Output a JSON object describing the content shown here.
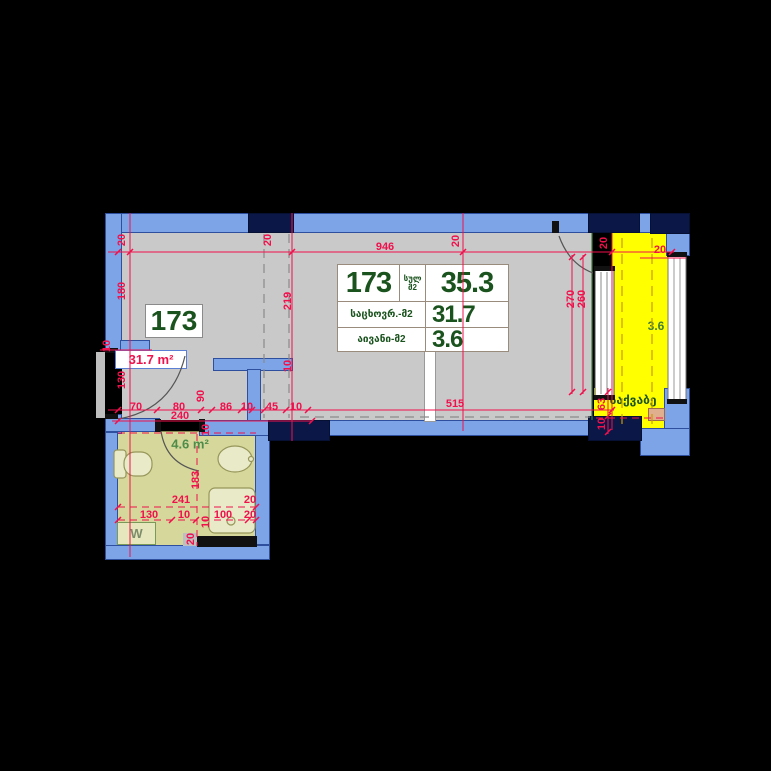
{
  "plan_title": "Apartment floor plan 173",
  "labels": {
    "unit_box": "173",
    "living_area_box": "31.7 m²",
    "bathroom_area": "4.6 m²",
    "balcony_area": "3.6",
    "boiler_room": "საქვაბე",
    "washing_machine": "W"
  },
  "area_table": {
    "unit": "173",
    "total_label_line1": "სულ",
    "total_label_line2": "მ2",
    "total_value": "35.3",
    "living_label": "საცხოვრ.-მ2",
    "living_value": "31.7",
    "balcony_label": "აივანი-მ2",
    "balcony_value": "3.6"
  },
  "dimensions": [
    {
      "t": "20",
      "cx": 122,
      "cy": 240,
      "r": 90
    },
    {
      "t": "180",
      "cx": 122,
      "cy": 291,
      "r": 90
    },
    {
      "t": "10",
      "cx": 107,
      "cy": 346,
      "r": 90
    },
    {
      "t": "130",
      "cx": 122,
      "cy": 380,
      "r": 90
    },
    {
      "t": "70",
      "cx": 136,
      "cy": 407,
      "r": 0
    },
    {
      "t": "80",
      "cx": 179,
      "cy": 407,
      "r": 0
    },
    {
      "t": "240",
      "cx": 180,
      "cy": 416,
      "r": 0
    },
    {
      "t": "90",
      "cx": 201,
      "cy": 396,
      "r": 90
    },
    {
      "t": "10",
      "cx": 206,
      "cy": 430,
      "r": 90
    },
    {
      "t": "86",
      "cx": 226,
      "cy": 407,
      "r": 0
    },
    {
      "t": "10",
      "cx": 247,
      "cy": 407,
      "r": 0
    },
    {
      "t": "45",
      "cx": 272,
      "cy": 407,
      "r": 0
    },
    {
      "t": "10",
      "cx": 296,
      "cy": 407,
      "r": 0
    },
    {
      "t": "20",
      "cx": 268,
      "cy": 240,
      "r": 90
    },
    {
      "t": "219",
      "cx": 288,
      "cy": 301,
      "r": 90
    },
    {
      "t": "10",
      "cx": 288,
      "cy": 366,
      "r": 90
    },
    {
      "t": "946",
      "cx": 385,
      "cy": 247,
      "r": 0
    },
    {
      "t": "20",
      "cx": 456,
      "cy": 241,
      "r": 90
    },
    {
      "t": "515",
      "cx": 455,
      "cy": 404,
      "r": 0
    },
    {
      "t": "270",
      "cx": 571,
      "cy": 299,
      "r": 90
    },
    {
      "t": "260",
      "cx": 582,
      "cy": 299,
      "r": 90
    },
    {
      "t": "20",
      "cx": 604,
      "cy": 243,
      "r": 90
    },
    {
      "t": "20",
      "cx": 660,
      "cy": 250,
      "r": 0
    },
    {
      "t": "63",
      "cx": 602,
      "cy": 404,
      "r": 90
    },
    {
      "t": "10",
      "cx": 602,
      "cy": 424,
      "r": 90
    },
    {
      "t": "183",
      "cx": 196,
      "cy": 480,
      "r": 90
    },
    {
      "t": "241",
      "cx": 181,
      "cy": 500,
      "r": 0
    },
    {
      "t": "130",
      "cx": 149,
      "cy": 515,
      "r": 0
    },
    {
      "t": "10",
      "cx": 184,
      "cy": 515,
      "r": 0
    },
    {
      "t": "100",
      "cx": 223,
      "cy": 515,
      "r": 0
    },
    {
      "t": "20",
      "cx": 250,
      "cy": 500,
      "r": 0
    },
    {
      "t": "20",
      "cx": 250,
      "cy": 515,
      "r": 0
    },
    {
      "t": "10",
      "cx": 206,
      "cy": 522,
      "r": 90
    },
    {
      "t": "20",
      "cx": 191,
      "cy": 539,
      "r": 90
    }
  ],
  "colors": {
    "wall_fill": "#7da4e6",
    "wall_stroke": "#2e4f9e",
    "column": "#0a1747",
    "room_floor": "#c9c9c9",
    "bathroom_floor": "#d6d79b",
    "balcony_floor": "#ffff00",
    "dimension_red": "#f0104c",
    "text_dark_green": "#1a531d",
    "text_mid_green": "#4d8c49"
  }
}
